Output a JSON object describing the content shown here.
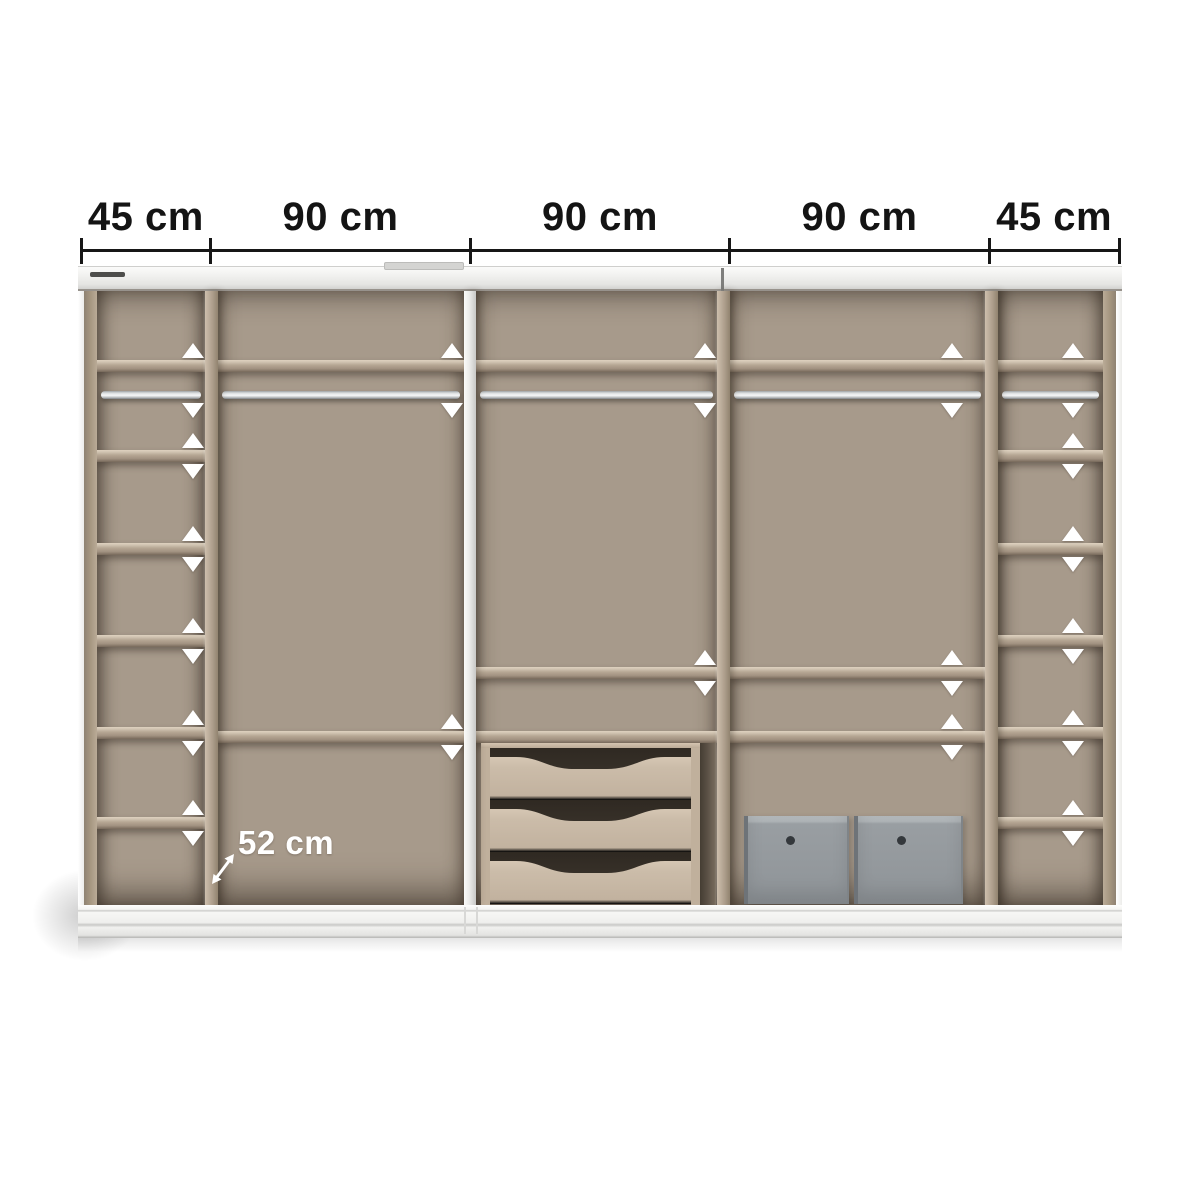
{
  "meta": {
    "description": "Wardrobe interior configuration diagram with width dimensions and depth label"
  },
  "dimension_line": {
    "labels": [
      "45 cm",
      "90 cm",
      "90 cm",
      "90 cm",
      "45 cm"
    ],
    "segments_cm": [
      45,
      90,
      90,
      90,
      45
    ],
    "total_cm": 360,
    "depth_label": "52 cm"
  },
  "colors": {
    "dimension_text": "#141414",
    "depth_text": "#ffffff",
    "back_panel": "#a79a8b",
    "wood": "#b6a794",
    "frame_white": "#f0f0ee",
    "rail_metal": "#eef0f1",
    "drawer_front": "#cbbca9",
    "drawer_gap": "#3a332b",
    "box_gray": "#94999d",
    "arrow_marker": "#ffffff"
  },
  "layout": {
    "dim": {
      "x0": 81,
      "x1": 1119,
      "line_y": 249,
      "line_h": 3,
      "tick_y": 238,
      "tick_h": 26,
      "tick_w": 3
    },
    "frame": {
      "x": 78,
      "w": 1044,
      "band_y": 266,
      "band_h": 25,
      "inner_top": 291,
      "inner_bottom": 905,
      "base_h": 33,
      "left_edge_w": 6,
      "wall_w": 13,
      "details": {
        "slot": {
          "x": 90,
          "y": 272,
          "w": 35,
          "h": 5
        },
        "tab": {
          "x": 384,
          "y": 262,
          "w": 78,
          "h": 6
        },
        "seam_x": 721,
        "base_seams": [
          464,
          476
        ]
      }
    },
    "shelf_h": 12,
    "rail_y": 391,
    "top_arrow_up_y": 343,
    "top_arrow_down_y": 403,
    "sections": [
      {
        "name": "column-left",
        "kind": "column",
        "x": 97,
        "w": 108,
        "arrows_x": 193,
        "shelves": [
          360,
          450,
          543,
          635,
          727,
          817
        ],
        "arrow_shelves": [
          450,
          543,
          635,
          727,
          817
        ],
        "rail": true
      },
      {
        "name": "bay-left-90",
        "kind": "bay",
        "x": 218,
        "w": 246,
        "arrows_x": 452,
        "shelves": [
          360,
          731
        ],
        "arrow_shelves": [
          731
        ],
        "rail": true,
        "has_depth_label": true
      },
      {
        "name": "bay-center-90",
        "kind": "bay",
        "x": 476,
        "w": 241,
        "arrows_x": 705,
        "shelves": [
          360,
          667,
          731
        ],
        "arrow_shelves": [
          667
        ],
        "rail": true,
        "has_drawers": true
      },
      {
        "name": "bay-right-90",
        "kind": "bay",
        "x": 730,
        "w": 255,
        "arrows_x": 952,
        "shelves": [
          360,
          667,
          731
        ],
        "arrow_shelves": [
          667,
          731
        ],
        "rail": true,
        "has_boxes": true
      },
      {
        "name": "column-right",
        "kind": "column",
        "x": 998,
        "w": 105,
        "arrows_x": 1073,
        "shelves": [
          360,
          450,
          543,
          635,
          727,
          817
        ],
        "arrow_shelves": [
          450,
          543,
          635,
          727,
          817
        ],
        "rail": true
      }
    ],
    "dividers": [
      {
        "x": 205,
        "w": 13,
        "kind": "wood"
      },
      {
        "x": 464,
        "w": 12,
        "kind": "white"
      },
      {
        "x": 717,
        "w": 13,
        "kind": "wood"
      },
      {
        "x": 985,
        "w": 13,
        "kind": "wood"
      }
    ],
    "drawer_unit": {
      "x": 481,
      "y": 743,
      "w": 219,
      "h": 162,
      "side_w": 9,
      "cap_h": 5,
      "rows": 3,
      "slot": {
        "x": 700,
        "w": 16
      }
    },
    "boxes": [
      {
        "x": 744,
        "y": 816,
        "w": 105,
        "h": 88
      },
      {
        "x": 854,
        "y": 816,
        "w": 109,
        "h": 88
      }
    ],
    "depth_arrow": {
      "x": 208,
      "y": 850,
      "w": 30,
      "h": 36
    }
  }
}
